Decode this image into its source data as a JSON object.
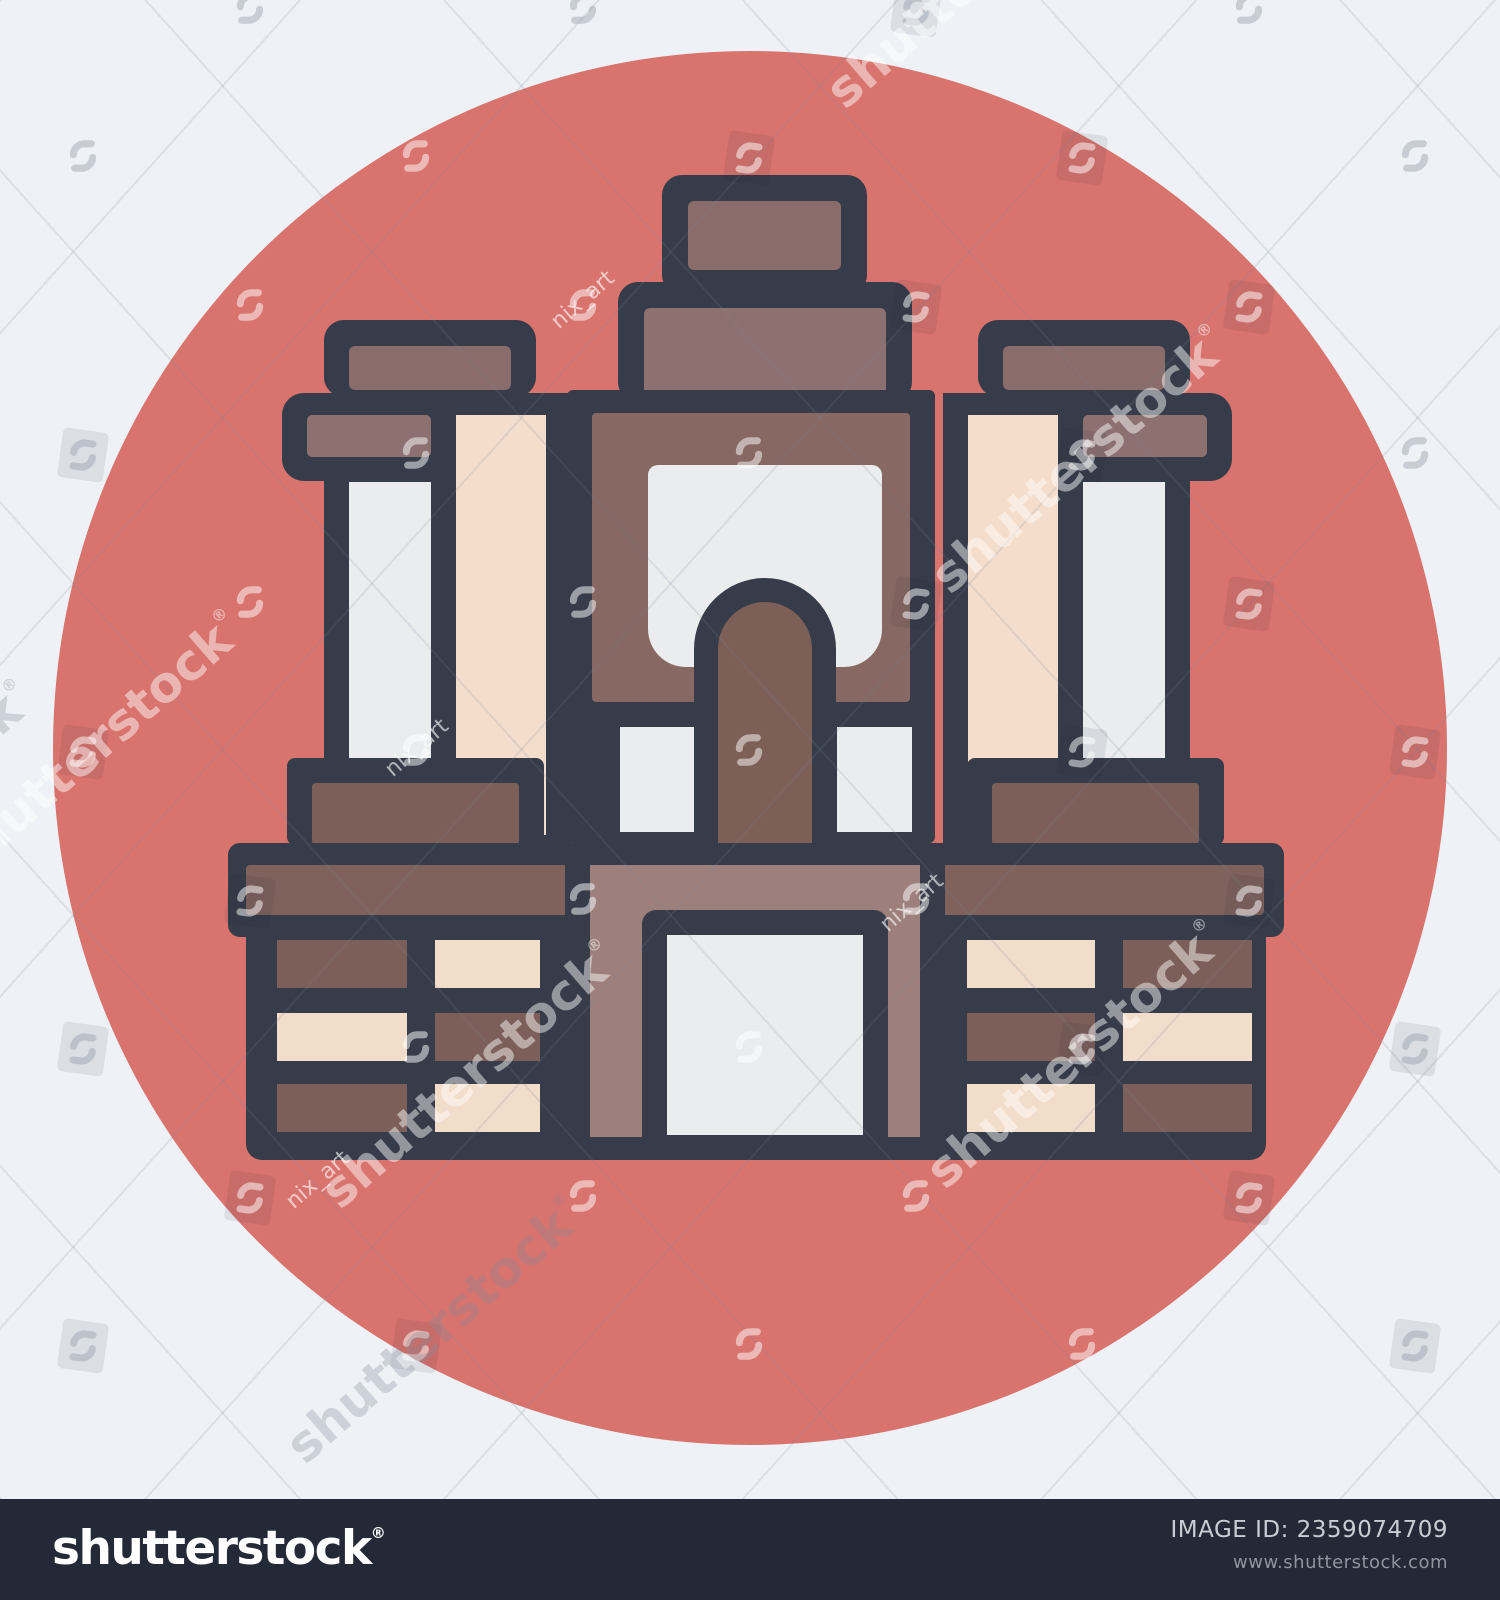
{
  "watermark": {
    "brand": "shutterstock",
    "registered": "®",
    "contributor": "nix_art"
  },
  "footer": {
    "logo": "shutterstock",
    "registered": "®",
    "image_id_line": "IMAGE ID: 2359074709",
    "url": "www.shutterstock.com"
  },
  "icons": {
    "shutterstock_mark": "interlocking-hooks"
  },
  "palette": {
    "bg": "#eef1f5",
    "circle": "#d9736e",
    "outline": "#363c49",
    "cap": "#8a6c6a",
    "capital": "#8d7170",
    "panel": "#876862",
    "pillar": "#7c5f57",
    "cream": "#f4ddcb",
    "white": "#eaecee",
    "beam": "#7f625c",
    "pedestal": "#7c5f59",
    "bay": "#9d807c",
    "brick_brown": "#7c5f58",
    "brick_cream": "#f2dcca",
    "footer_bg": "#232936",
    "footer_text": "#c9cdd3",
    "footer_muted": "#8e959f",
    "logo": "#fdfdfd"
  }
}
